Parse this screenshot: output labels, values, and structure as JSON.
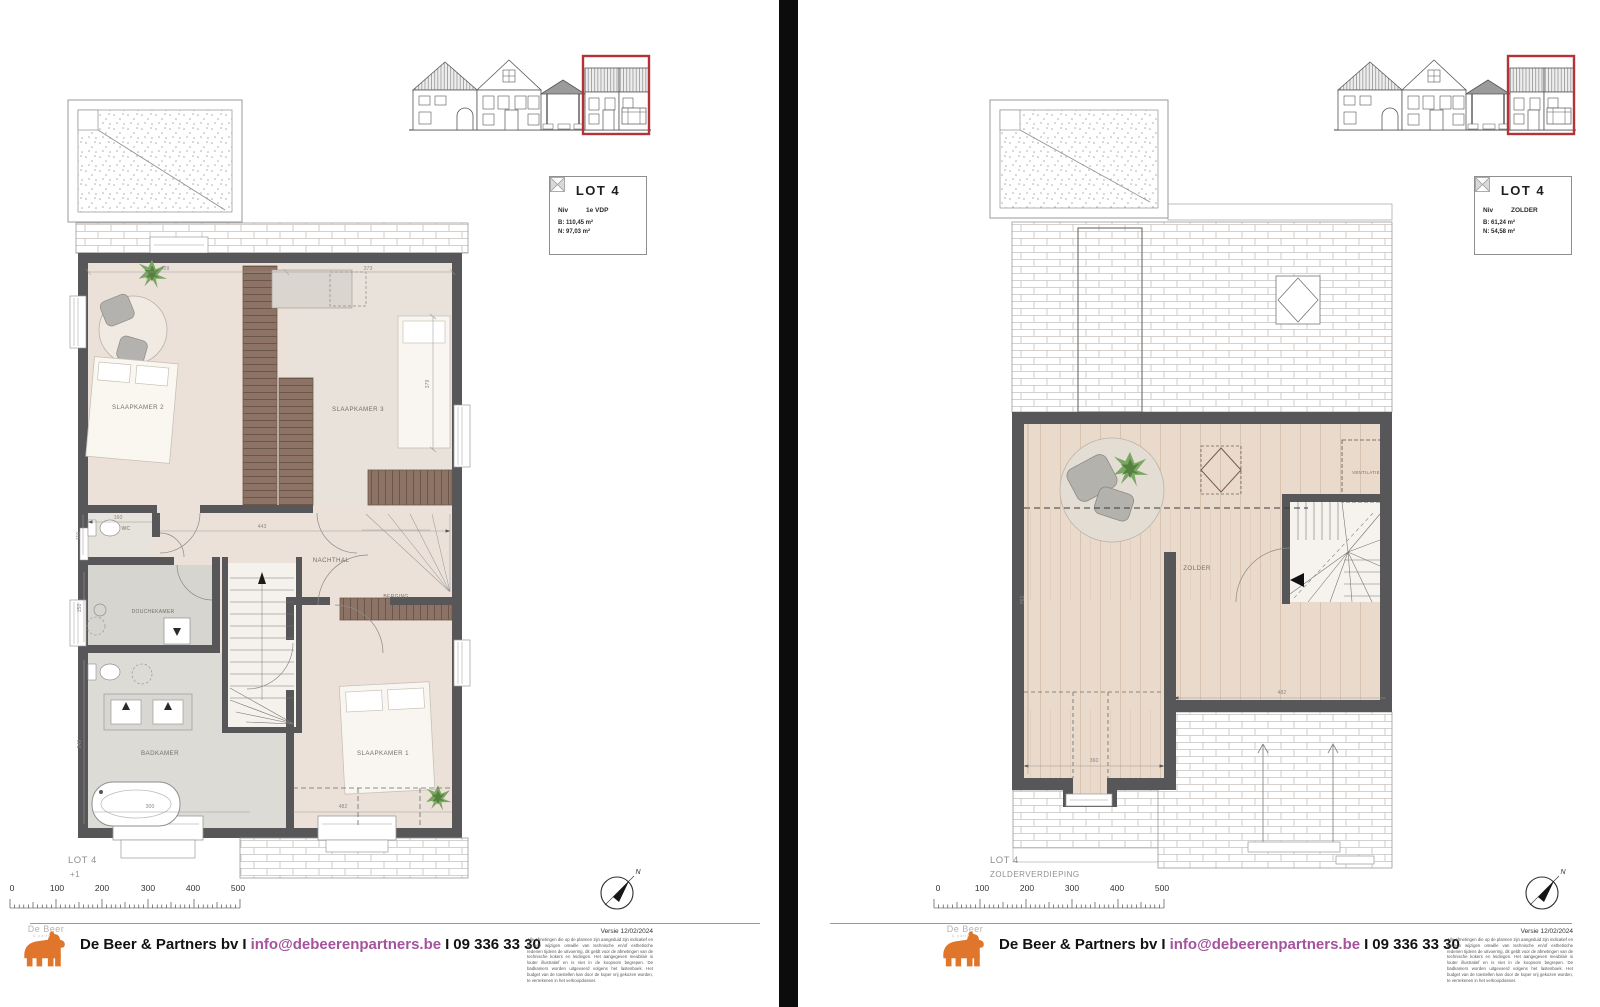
{
  "left_page": {
    "info_box": {
      "title": "LOT 4",
      "niv_label": "Niv",
      "niv_value": "1e VDP",
      "area_gross": "B: 110,45 m²",
      "area_net": "N: 97,03 m²"
    },
    "plan_name": "LOT 4",
    "plan_level": "+1",
    "rooms": {
      "slaapkamer2": "SLAAPKAMER 2",
      "slaapkamer3": "SLAAPKAMER 3",
      "slaapkamer1": "SLAAPKAMER 1",
      "nachthal": "NACHTHAL",
      "berging": "BERGING",
      "wc": "WC",
      "douchekamer": "DOUCHEKAMER",
      "badkamer": "BADKAMER"
    },
    "dims": {
      "d409": "409",
      "d373": "373",
      "d379": "379",
      "d160": "160",
      "d443": "443",
      "d110": "110",
      "d150": "150",
      "d249": "249",
      "d300": "300",
      "d482": "482"
    }
  },
  "right_page": {
    "info_box": {
      "title": "LOT 4",
      "niv_label": "Niv",
      "niv_value": "ZOLDER",
      "area_gross": "B: 61,24 m²",
      "area_net": "N: 54,58 m²"
    },
    "plan_name": "LOT 4",
    "plan_level": "ZOLDERVERDIEPING",
    "rooms": {
      "zolder": "ZOLDER",
      "ventilatie": "VENTILATIE"
    },
    "dims": {
      "d482": "482",
      "d761": "761",
      "d360": "360"
    }
  },
  "scale": {
    "ticks": [
      "0",
      "100",
      "200",
      "300",
      "400",
      "500"
    ]
  },
  "compass": {
    "north": "N"
  },
  "footer": {
    "company": "De Beer & Partners bv",
    "separator": "I",
    "email": "info@debeerenpartners.be",
    "phone": "09 336 33 30",
    "logo_text": "De Beer",
    "logo_subtext": "& partners",
    "version": "Versie 12/02/2024",
    "disclaimer": "Alle afmetingen die op de plannen zijn aangeduid zijn indicatief en kunnen wijzigen omwille van technische en/of esthetische redenen tijdens de uitvoering, dit geldt voor de afmetingen van de technische kokers en leidingen. Het aangegeven meubilair is louter illustratief en is niet in de koopsom begrepen. De badkamers worden uitgevoerd volgens het lastenboek. Het budget van de toestellen kan door de koper vrij gekozen worden, te verrekenen in het verkoopdossier."
  }
}
